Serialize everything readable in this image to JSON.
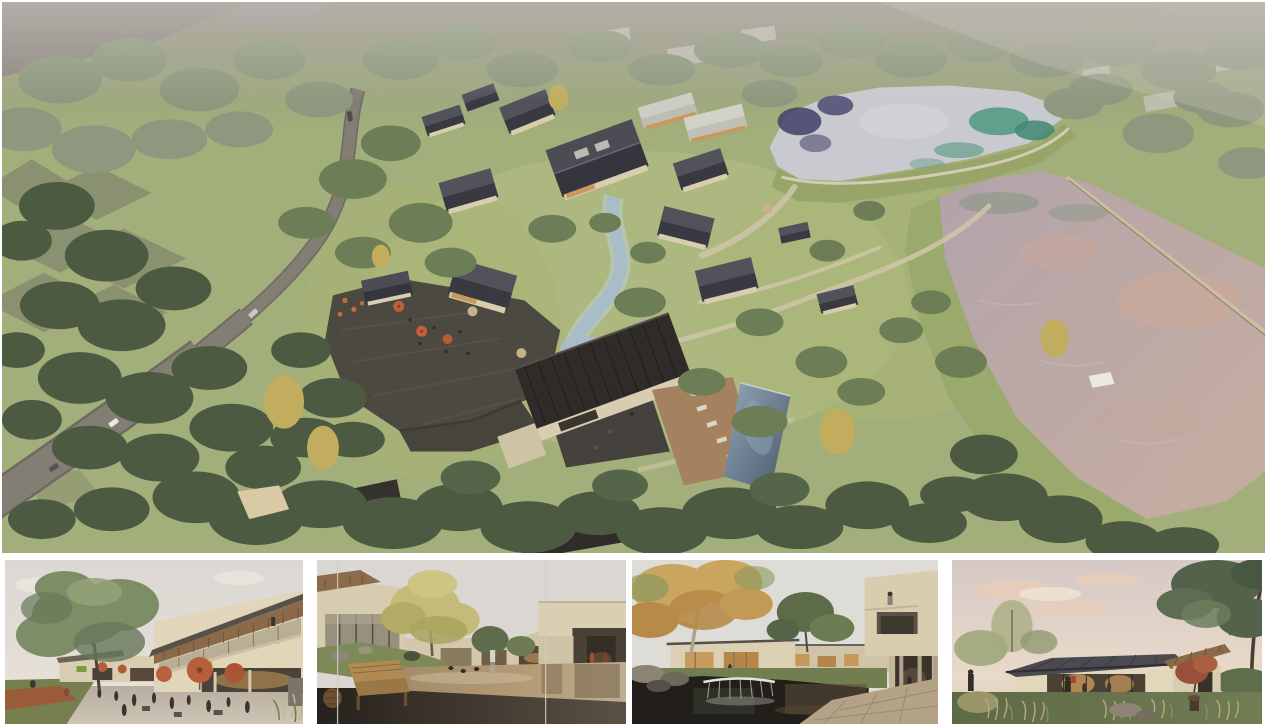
{
  "page": {
    "description": "Architectural rendering board: large aerial masterplan view of a lakeside village resort above four eye-level exterior renderings",
    "background": "#ffffff"
  },
  "main_render": {
    "alt": "Aerial rendering of a village resort: dark pitched-roof houses clustered around a central stream, terraced stone courtyards with red umbrellas, a main hall with swimming pool and sun deck, a winding grey access road through woodland on the left, and two reflective lakes separated by a grass dam on the right",
    "palette": {
      "haze": "#8f8984",
      "grass": "#a2af7a",
      "grass_bright": "#b4bf85",
      "tree_dark": "#4b5a41",
      "tree_mid": "#6d7d55",
      "tree_pale": "#8d987e",
      "tree_gold": "#c2ad5f",
      "road": "#837e74",
      "roof_dark": "#3f3f47",
      "roof_deep": "#2f2b28",
      "wall_cream": "#ddd2b6",
      "terrace_stone": "#46433d",
      "path": "#cfc6aa",
      "stream": "#a9bdc9",
      "pool_deep": "#50606e",
      "deck_wood": "#a5825f",
      "water_upper": "#c9cad0",
      "water_teal": "#4a937c",
      "reflection_navy": "#423f66",
      "water_lower": "#b7a6ad",
      "water_peach": "#cfa795",
      "umbrella_red": "#c06038",
      "umbrella_tan": "#c8b089"
    }
  },
  "thumbnails": [
    {
      "label": "plaza-cafe-view",
      "alt": "Eye-level rendering of a village plaza: large green tree on the left, two-storey building with sloping timber-soffit roof and balcony on the right, red cafe umbrellas and people seated at outdoor tables",
      "sky": "#dbd7d2"
    },
    {
      "label": "courtyard-pond-view",
      "alt": "Eye-level rendering of a courtyard with a warm reflecting pond between cream buildings, a golden tree in the centre, a wooden bench and carved stool on dark paving in the foreground",
      "sky": "#dad7d3"
    },
    {
      "label": "cantilever-pond-view",
      "alt": "Eye-level rendering of cantilevered cream volumes above a dark pond with a waterfall weir, an autumn tree on the left, stone paving in front and a figure standing on the upper balcony",
      "sky": "#dedcd7"
    },
    {
      "label": "garden-pavilion-view",
      "alt": "Eye-level rendering of a single-storey glass pavilion with a long dark hipped roof in a garden of ornamental grasses and rocks, large tree to the right, under a soft pink evening sky",
      "sky": "#d9cdc8"
    }
  ]
}
